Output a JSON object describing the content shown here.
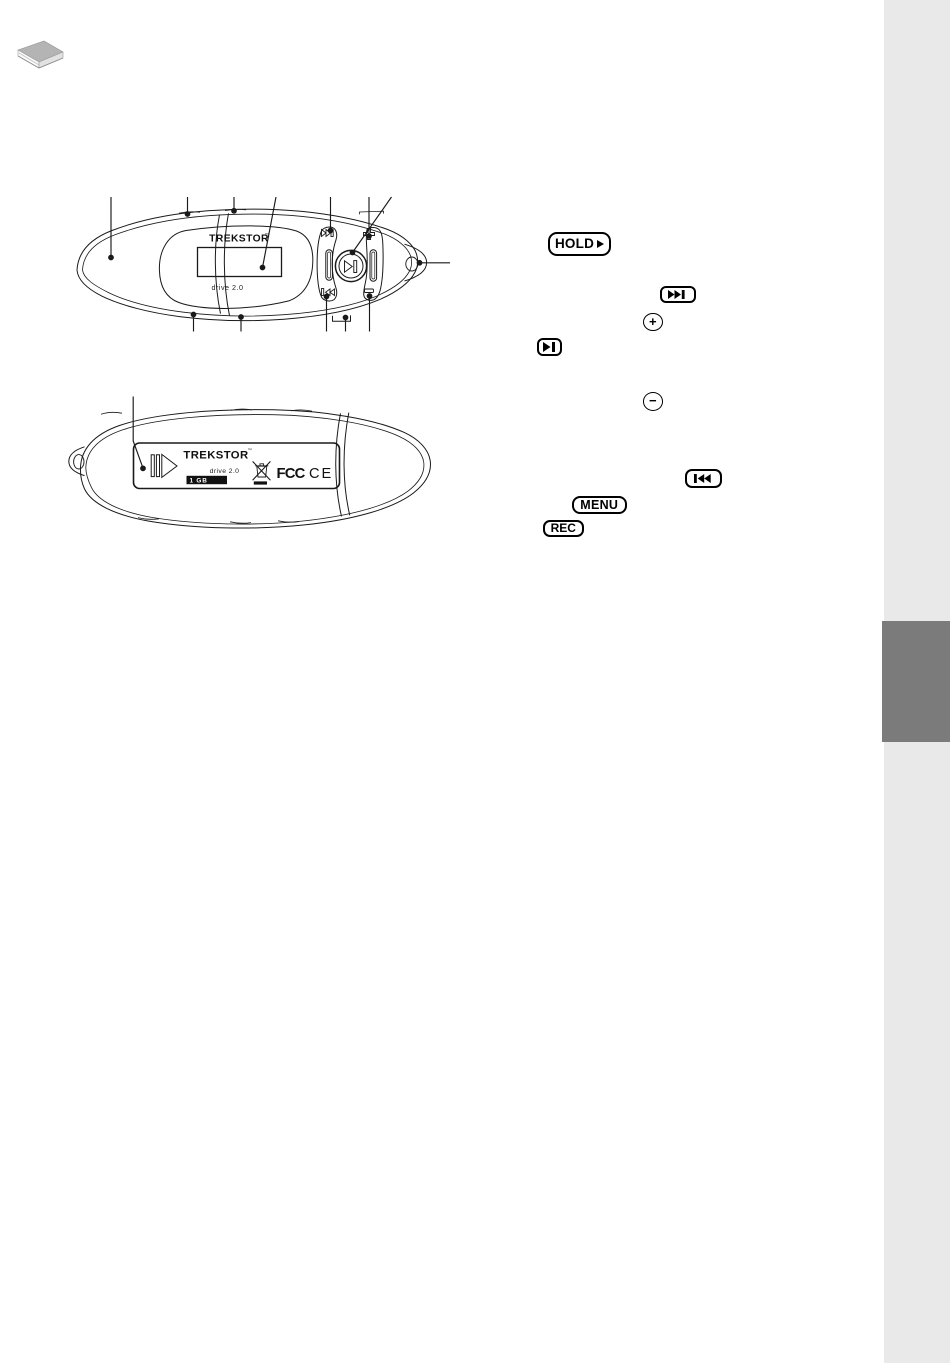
{
  "page": {
    "background": "#ffffff",
    "sidebar_color": "#e9e9e9",
    "sidebar_tab_color": "#7b7b7b",
    "line_color": "#1a1a1a"
  },
  "header": {
    "icon": "book-icon"
  },
  "device_top": {
    "brand": "TrekStor",
    "tm": "™",
    "model": "drive 2.0",
    "parts": [
      "cap",
      "top-edge",
      "top-seam",
      "display",
      "skip-forward-button",
      "volume-up-button",
      "play-pause-button",
      "lanyard-eyelet",
      "bottom-edge",
      "skip-backward-button",
      "usb-cover",
      "volume-down-button"
    ]
  },
  "device_back": {
    "brand": "TrekStor",
    "tm": "™",
    "model": "drive 2.0",
    "capacity": "1 GB",
    "fcc_mark": "FCC",
    "ce_mark": "CE",
    "label_icons": [
      "hold-symbol",
      "weee-bin-icon",
      "fcc-logo",
      "ce-logo"
    ]
  },
  "badges": {
    "hold": {
      "label": "HOLD",
      "icon": "arrow-right"
    },
    "skip_forward": {
      "icon": "skip-forward"
    },
    "volume_up": {
      "label": "+"
    },
    "play_pause": {
      "icon": "play-pause"
    },
    "volume_down": {
      "label": "−"
    },
    "skip_back": {
      "icon": "skip-backward"
    },
    "menu": {
      "label": "MENU"
    },
    "rec": {
      "label": "REC"
    }
  }
}
